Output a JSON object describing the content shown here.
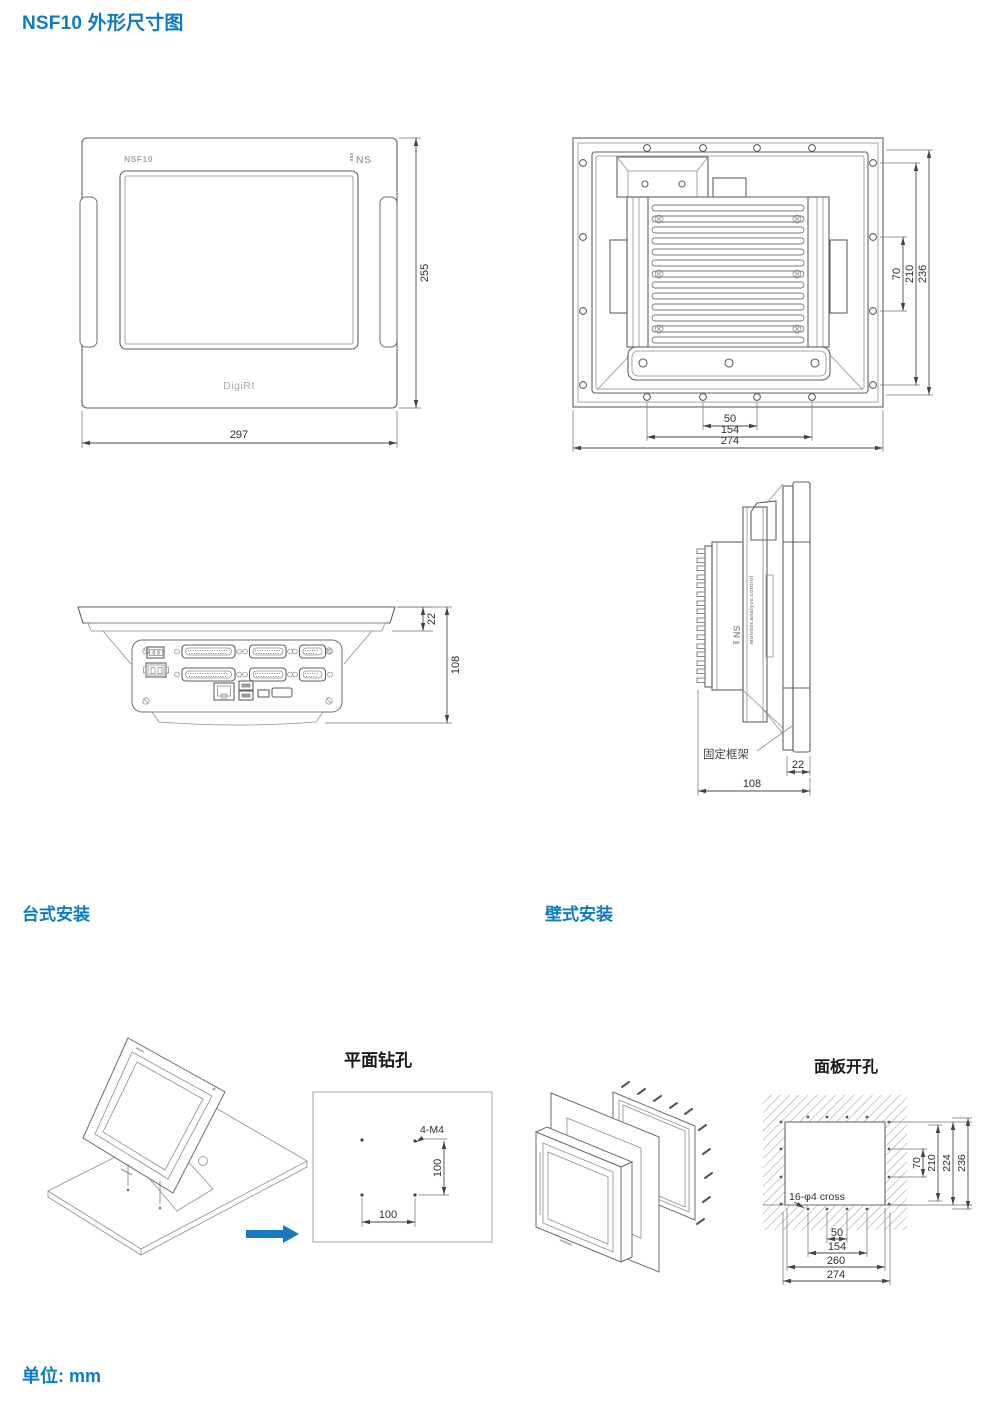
{
  "page": {
    "title": "NSF10 外形尺寸图",
    "unit_label": "单位: mm",
    "accent_color": "#0d7cc1",
    "arrow_color": "#1779c4"
  },
  "front_view": {
    "model": "NSF10",
    "logo": "NS",
    "brand": "DigiRt",
    "dim_height": "255",
    "dim_width": "297"
  },
  "rear_view": {
    "dim_v_inner": "70",
    "dim_v_mid": "210",
    "dim_v_outer": "236",
    "dim_h_inner": "50",
    "dim_h_mid": "154",
    "dim_h_outer": "274"
  },
  "bottom_view": {
    "dim_bezel": "22",
    "dim_depth": "108"
  },
  "side_view": {
    "logo": "NS",
    "tagline": "monitor.analyze.control",
    "frame_label": "固定框架",
    "dim_bezel": "22",
    "dim_depth": "108"
  },
  "desktop_section": {
    "heading": "台式安装",
    "drill_title": "平面钻孔",
    "hole_spec": "4-M4",
    "dim_vertical": "100",
    "dim_horizontal": "100"
  },
  "wall_section": {
    "heading": "壁式安装",
    "cutout_title": "面板开孔",
    "hole_spec": "16-φ4 cross",
    "dim_v_70": "70",
    "dim_v_210": "210",
    "dim_v_224": "224",
    "dim_v_236": "236",
    "dim_h_50": "50",
    "dim_h_154": "154",
    "dim_h_260": "260",
    "dim_h_274": "274"
  }
}
